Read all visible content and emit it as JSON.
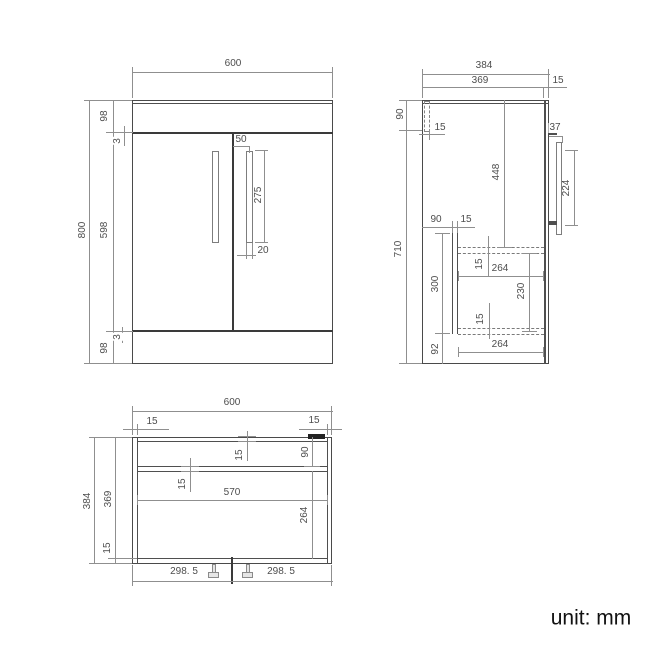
{
  "front_view": {
    "width": "600",
    "height": "800",
    "top_rail": "98",
    "gap_top": "3",
    "door_height": "598",
    "gap_bottom": "3",
    "plinth": "98",
    "handle_offset": "50",
    "handle_length": "275",
    "handle_width": "20"
  },
  "side_view": {
    "depth": "384",
    "body_depth": "369",
    "door_thickness": "15",
    "rail_height": "90",
    "rail_thickness": "15",
    "height": "710",
    "upper_interior": "448",
    "handle_standoff": "37",
    "handle_centres": "224",
    "recess_depth": "90",
    "panel_thickness": "15",
    "lower_section": "300",
    "shelf_thickness_top": "15",
    "shelf_depth_top": "264",
    "shelf_gap": "230",
    "shelf_thickness_bottom": "15",
    "base_height": "92",
    "shelf_depth_bottom": "264"
  },
  "plan_view": {
    "width": "600",
    "side_thickness_left": "15",
    "side_thickness_right": "15",
    "depth": "384",
    "inner_depth": "369",
    "front_thickness": "15",
    "back_thickness": "15",
    "rail_depth": "90",
    "rail_thickness": "15",
    "inner_width": "570",
    "open_depth": "264",
    "half_left": "298. 5",
    "half_right": "298. 5"
  },
  "footer": {
    "unit_label": "unit: mm"
  }
}
